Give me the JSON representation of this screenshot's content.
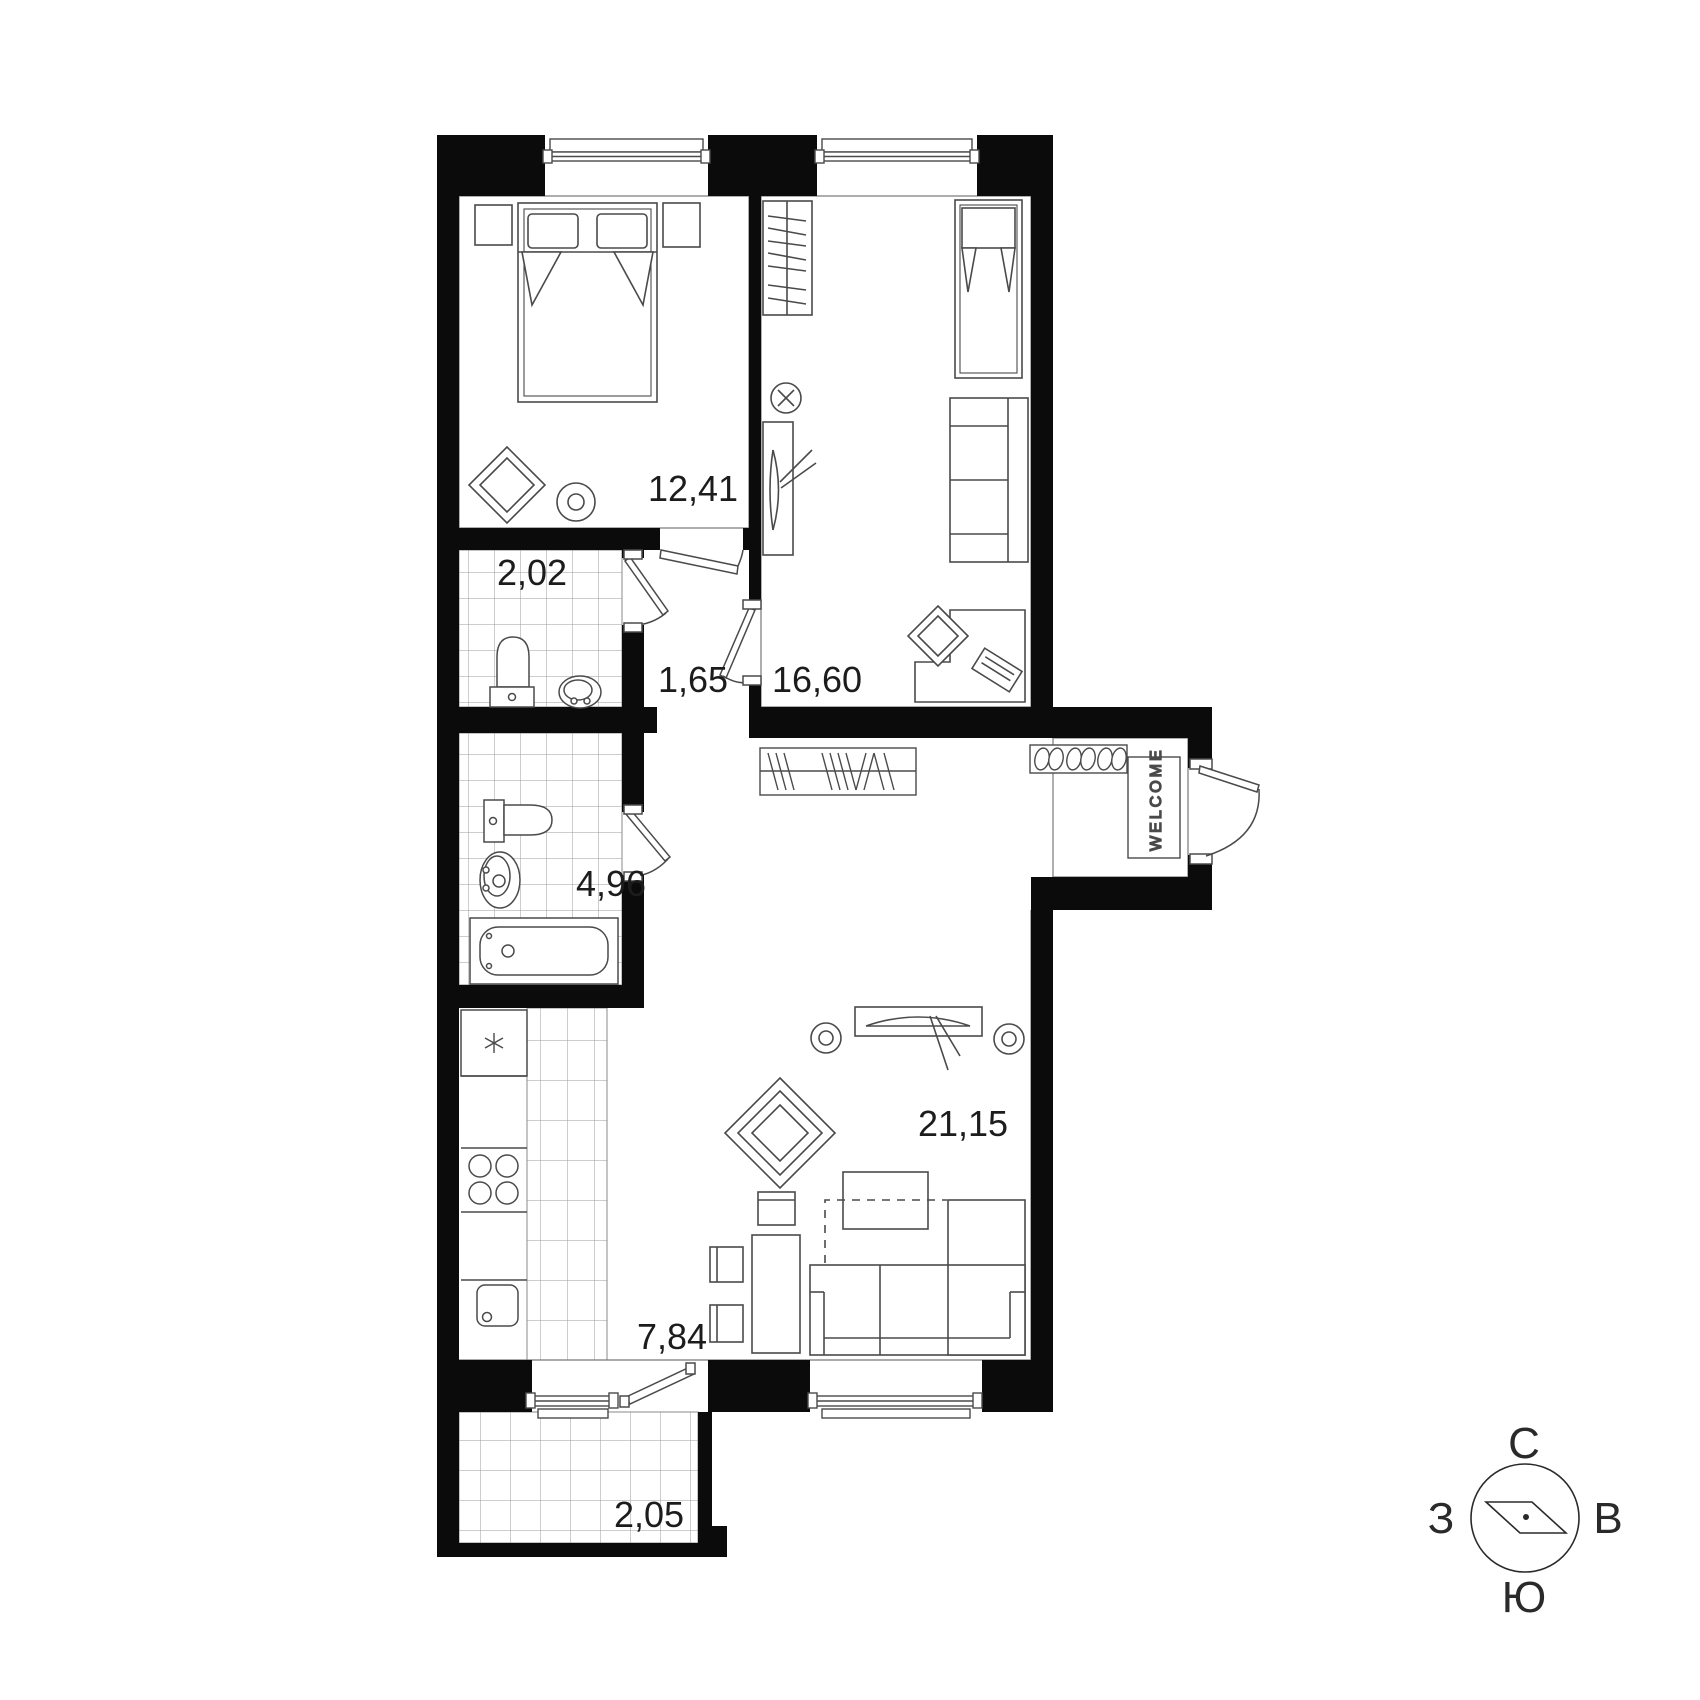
{
  "plan_title": "apartment-floor-plan",
  "rooms": [
    {
      "name": "bedroom",
      "area": "12,41"
    },
    {
      "name": "toilet-wc",
      "area": "2,02"
    },
    {
      "name": "hallway",
      "area": "1,65"
    },
    {
      "name": "living-room",
      "area": "16,60"
    },
    {
      "name": "bathroom",
      "area": "4,96"
    },
    {
      "name": "lounge",
      "area": "21,15"
    },
    {
      "name": "kitchen",
      "area": "7,84"
    },
    {
      "name": "balcony",
      "area": "2,05"
    }
  ],
  "entrance": {
    "doormat_text": "WELCOME"
  },
  "compass": {
    "north": "С",
    "east": "В",
    "south": "Ю",
    "west": "З"
  },
  "colors": {
    "wall": "#0b0b0b",
    "furniture_line": "#4a4a4a",
    "tile_line": "#9b9b9b",
    "label": "#1c1c1c",
    "background": "#ffffff"
  }
}
